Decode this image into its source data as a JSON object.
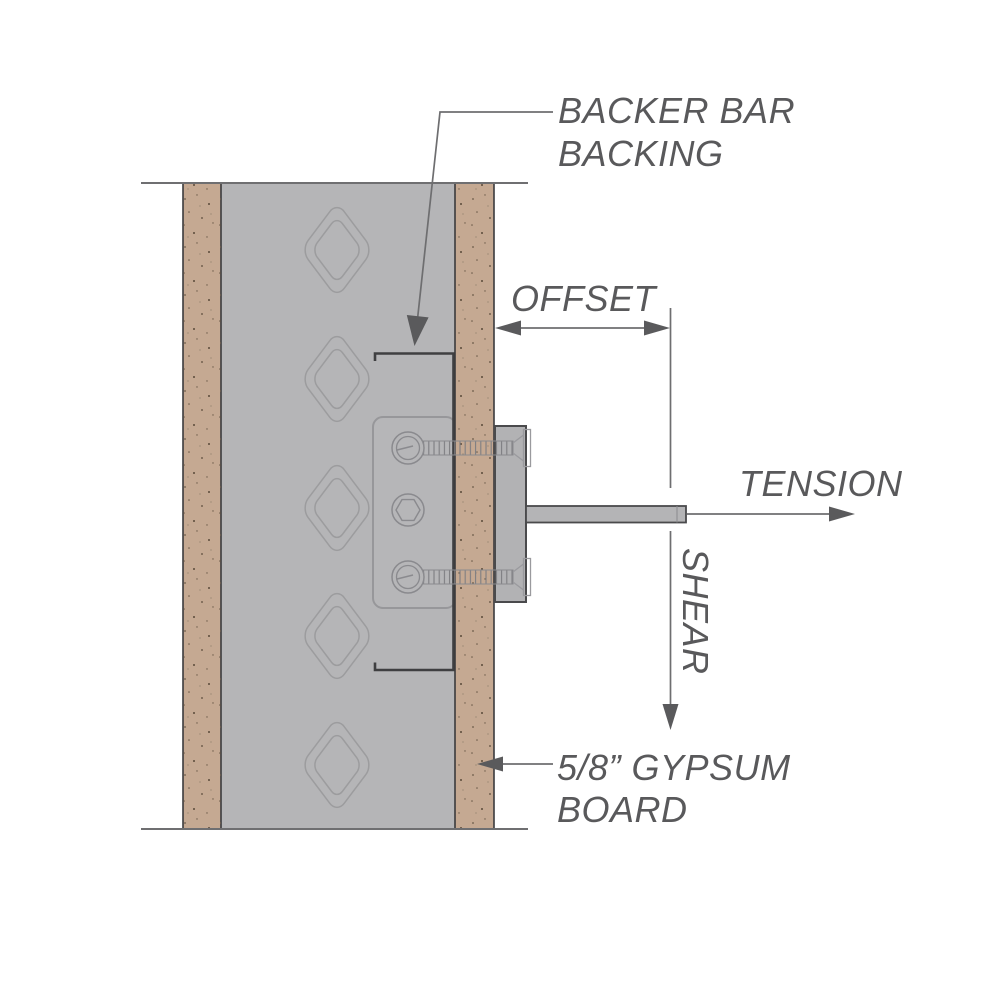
{
  "diagram": {
    "type": "construction-detail-section",
    "labels": {
      "backer_bar_line1": "BACKER BAR",
      "backer_bar_line2": "BACKING",
      "offset": "OFFSET",
      "tension": "TENSION",
      "shear": "SHEAR",
      "gypsum_line1": "5/8” GYPSUM",
      "gypsum_line2": "BOARD"
    },
    "colors": {
      "stud_gray": "#b5b5b7",
      "plate_gray": "#b6b6b8",
      "block_gray": "#b2b2b4",
      "rod_gray": "#b4b4b6",
      "gypsum_tan": "#c5a992",
      "dark_line": "#4a4a4c",
      "bar_line": "#3f3f41",
      "light_outline": "#97979a",
      "annotation_line": "#6e6e70",
      "arrow_fill": "#5a5a5c",
      "text_gray": "#59595b",
      "knockout_outline": "#9c9c9e",
      "speckle": "#6a5948"
    }
  }
}
